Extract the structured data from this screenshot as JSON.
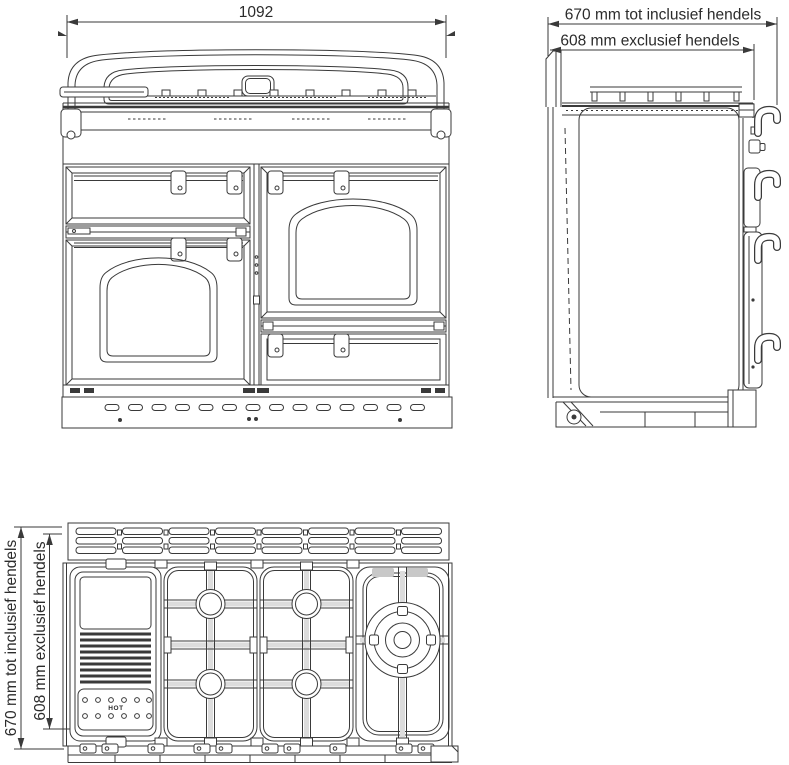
{
  "drawing": {
    "kind": "technical dimension drawing",
    "views": [
      "front",
      "side",
      "top"
    ]
  },
  "colors": {
    "line": "#3a3a3a",
    "text": "#2b2b2b",
    "background": "#ffffff",
    "grey_tab": "#c8c8c8",
    "bar_shade": "#dcdcdc"
  },
  "front_view": {
    "width_dimension_label": "1092"
  },
  "side_view": {
    "depth_including_handles_label": "670 mm tot inclusief hendels",
    "depth_excluding_handles_label": "608 mm exclusief hendels"
  },
  "top_view": {
    "depth_including_handles_label": "670 mm tot inclusief hendels",
    "depth_excluding_handles_label": "608 mm exclusief hendels",
    "griddle_hot_label": "HOT"
  }
}
